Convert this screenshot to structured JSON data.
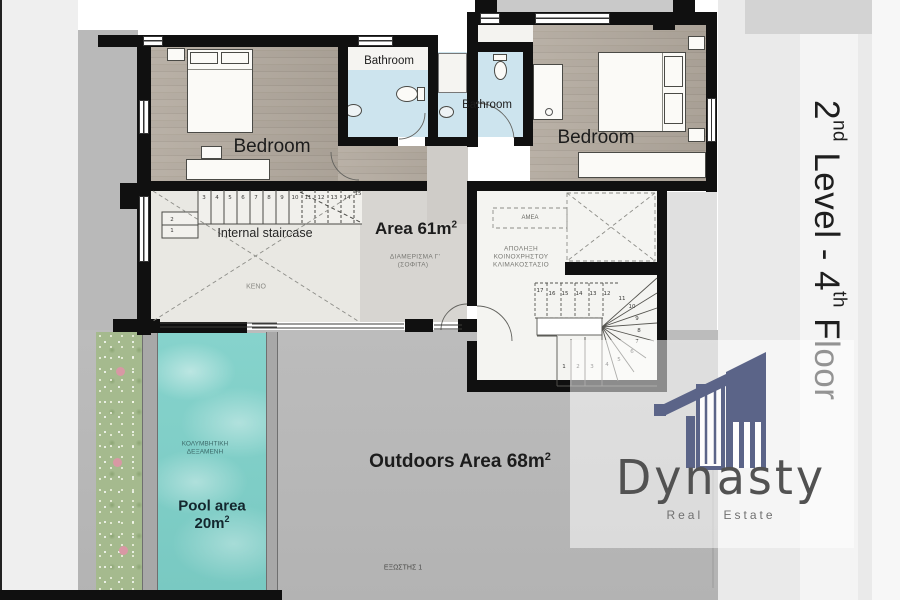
{
  "plan": {
    "labels": {
      "bedroom_left": "Bedroom",
      "bedroom_right": "Bedroom",
      "bathroom_left": "Bathroom",
      "bathroom_right": "Bathroom",
      "internal_staircase": "Internal staircase",
      "area": {
        "text": "Area 61m",
        "sup": "2"
      },
      "apartment_greek_1": "ΔΙΑΜΕΡΙΣΜΑ Γ'",
      "apartment_greek_2": "(ΣΟΦΙΤΑ)",
      "void_greek": "ΚΕΝΟ",
      "accessible_greek": "ΑΜΕΑ",
      "stairwell_greek_1": "ΑΠΟΛΗΞΗ",
      "stairwell_greek_2": "ΚΟΙΝΟΧΡΗΣΤΟΥ",
      "stairwell_greek_3": "ΚΛΙΜΑΚΟΣΤΑΣΙΟ",
      "pool_greek_1": "ΚΟΛΥΜΒΗΤΙΚΗ",
      "pool_greek_2": "ΔΕΞΑΜΕΝΗ",
      "pool_area_line1": "Pool area",
      "pool_area_value": "20m",
      "pool_area_sup": "2",
      "outdoors": {
        "text": "Outdoors Area 68m",
        "sup": "2"
      },
      "balcony_greek": "ΕΞΩΣΤΗΣ 1"
    },
    "internal_stair_numbers": [
      "1",
      "2",
      "3",
      "4",
      "5",
      "6",
      "7",
      "8",
      "9",
      "10",
      "11",
      "12",
      "13",
      "14",
      "15"
    ],
    "winding_stair_numbers": [
      "1",
      "2",
      "3",
      "4",
      "5",
      "6",
      "7",
      "8",
      "9",
      "10",
      "11",
      "12",
      "13",
      "14",
      "15",
      "16",
      "17"
    ]
  },
  "side_label": {
    "p1": "2",
    "s1": "nd",
    "p2": " Level - 4",
    "s2": "th",
    "p3": " Floor"
  },
  "logo": {
    "name": "Dynasty",
    "tagline": "Real Estate"
  },
  "colors": {
    "wall": "#101010",
    "water": "#7fccc6",
    "bathroom_floor": "#cde4ee",
    "outdoor_gray": "#b8b8b8",
    "logo_blue": "#5b6488"
  }
}
